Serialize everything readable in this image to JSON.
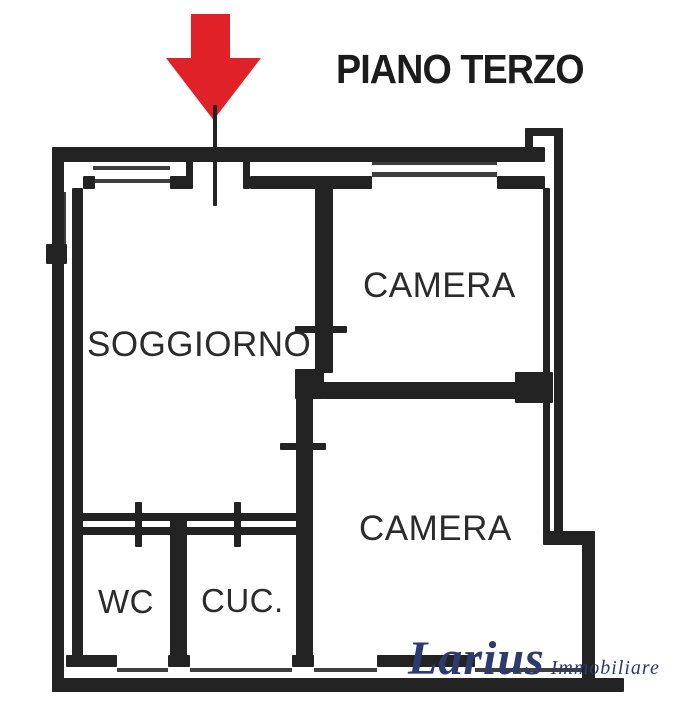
{
  "title": "PIANO TERZO",
  "rooms": {
    "soggiorno": {
      "label": "SOGGIORNO"
    },
    "camera_top": {
      "label": "CAMERA"
    },
    "camera_bottom": {
      "label": "CAMERA"
    },
    "wc": {
      "label": "WC"
    },
    "cucina": {
      "label": "CUC."
    }
  },
  "watermark": {
    "brand": "Larius",
    "suffix": "Immobiliare"
  },
  "colors": {
    "arrow_red": "#e02128",
    "wall_ink": "#232323",
    "label_ink": "#2b2b2b",
    "logo_blue": "#2c3a6d"
  }
}
